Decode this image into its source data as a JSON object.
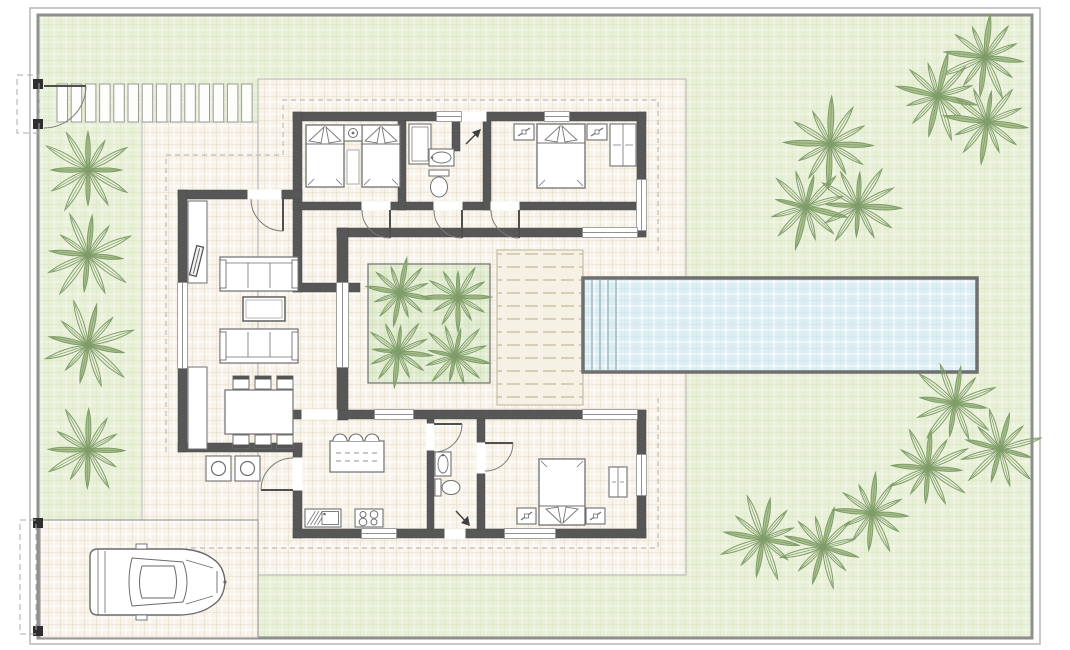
{
  "canvas": {
    "width": 1070,
    "height": 650,
    "background": "#ffffff"
  },
  "colors": {
    "wall": "#575757",
    "wall_light": "#6e6e6e",
    "line": "#6a6a6a",
    "furn": "#707070",
    "garden_bg": "#e8efd7",
    "garden_line": "#f6f9ee",
    "terrace_bg": "#f7f3ea",
    "terrace_line": "#ffffff",
    "terrace_accent": "#e4dac7",
    "planter_bg": "#dfead0",
    "planter_line": "#f0f6e3",
    "pool_bg": "#ddeef3",
    "pool_line": "#ffffff",
    "pool_border": "#6f6f6f",
    "palm": "#7f9c69",
    "palm_fill": "#a9c08d",
    "border_outer": "#b7b7b7",
    "border_inner": "#8f8f8f",
    "dash": "#bdbdbd",
    "deck_dash": "#c6b999",
    "white": "#ffffff"
  },
  "plot": {
    "outer": [
      30,
      8,
      1010,
      636
    ],
    "inner": [
      38,
      15,
      994,
      623
    ]
  },
  "regions": [
    {
      "name": "terrace-west",
      "rect": [
        142,
        122,
        116,
        453
      ],
      "pat": "patTerrace",
      "stroke": "#c6c6c6"
    },
    {
      "name": "terrace-main",
      "rect": [
        258,
        79,
        428,
        496
      ],
      "pat": "patTerrace",
      "stroke": "#bdbdbd"
    },
    {
      "name": "driveway",
      "rect": [
        40,
        520,
        218,
        118
      ],
      "pat": "patTerrace",
      "stroke": "#9e9e9e"
    },
    {
      "name": "deck",
      "rect": [
        497,
        250,
        86,
        155
      ],
      "pat": "patDeck",
      "stroke": "#c9bda6"
    },
    {
      "name": "courtyard-planter",
      "rect": [
        368,
        264,
        122,
        119
      ],
      "pat": "patPlanter",
      "stroke": "#6f6f6f"
    }
  ],
  "slabs": {
    "x0": 57,
    "y": 84,
    "w": 10.5,
    "h": 38,
    "pitch": 14.2,
    "count": 14
  },
  "pool": {
    "rect": [
      583,
      278,
      394,
      94
    ],
    "steps_x": [
      592,
      600,
      608,
      616
    ]
  },
  "overhang_dashes": [
    [
      [
        166,
        452
      ],
      [
        166,
        155
      ],
      [
        283,
        155
      ],
      [
        283,
        100
      ],
      [
        658,
        100
      ],
      [
        658,
        252
      ]
    ],
    [
      [
        658,
        398
      ],
      [
        658,
        548
      ],
      [
        186,
        548
      ]
    ]
  ],
  "walls": [
    [
      293,
      112,
      353,
      9
    ],
    [
      293,
      112,
      9,
      180
    ],
    [
      637,
      112,
      9,
      125
    ],
    [
      293,
      202,
      353,
      8
    ],
    [
      398,
      121,
      8,
      89
    ],
    [
      483,
      121,
      8,
      89
    ],
    [
      452,
      121,
      8,
      30
    ],
    [
      337,
      228,
      309,
      9
    ],
    [
      337,
      228,
      11,
      192
    ],
    [
      293,
      283,
      67,
      9
    ],
    [
      178,
      190,
      124,
      9
    ],
    [
      178,
      190,
      9,
      262
    ],
    [
      178,
      443,
      124,
      9
    ],
    [
      293,
      410,
      353,
      9
    ],
    [
      293,
      443,
      9,
      95
    ],
    [
      637,
      410,
      9,
      128
    ],
    [
      293,
      529,
      353,
      9
    ],
    [
      427,
      419,
      7,
      110
    ],
    [
      477,
      419,
      8,
      110
    ]
  ],
  "windows": [
    [
      437,
      112,
      24,
      9,
      "h"
    ],
    [
      545,
      112,
      24,
      9,
      "h"
    ],
    [
      637,
      180,
      9,
      50,
      "v"
    ],
    [
      583,
      228,
      54,
      9,
      "h"
    ],
    [
      337,
      283,
      11,
      84,
      "v"
    ],
    [
      178,
      283,
      9,
      85,
      "v"
    ],
    [
      375,
      410,
      38,
      9,
      "h"
    ],
    [
      583,
      410,
      54,
      9,
      "h"
    ],
    [
      637,
      455,
      9,
      40,
      "v"
    ],
    [
      362,
      529,
      34,
      9,
      "h"
    ],
    [
      505,
      529,
      50,
      9,
      "h"
    ]
  ],
  "gaps": [
    [
      462,
      112,
      24,
      9
    ],
    [
      248,
      190,
      33,
      9
    ],
    [
      362,
      202,
      28,
      8
    ],
    [
      434,
      202,
      28,
      8
    ],
    [
      491,
      202,
      28,
      8
    ],
    [
      302,
      410,
      35,
      9
    ],
    [
      293,
      458,
      9,
      32
    ],
    [
      427,
      424,
      7,
      26
    ],
    [
      477,
      443,
      8,
      30
    ],
    [
      445,
      529,
      20,
      9
    ]
  ],
  "doors": [
    {
      "name": "pedestrian-gate-door",
      "leaf": "M44,86 L86,86",
      "arc": "M86,86 A42,42 0 0 1 44,128"
    },
    {
      "name": "living-terrace-door",
      "leaf": "M283,199 L283,231",
      "arc": "M283,231 A32,32 0 0 1 251,199"
    },
    {
      "name": "bedroom1-door",
      "leaf": "M390,210 L390,238",
      "arc": "M390,238 A28,28 0 0 1 362,210"
    },
    {
      "name": "bathroom1-door",
      "leaf": "M462,210 L462,238",
      "arc": "M462,238 A28,28 0 0 1 434,210"
    },
    {
      "name": "bedroom2-door",
      "leaf": "M519,210 L519,238",
      "arc": "M519,238 A28,28 0 0 1 491,210"
    },
    {
      "name": "kitchen-porch-door",
      "leaf": "M293,490 L261,490",
      "arc": "M261,490 A32,32 0 0 1 293,458"
    },
    {
      "name": "bathroom2-door",
      "leaf": "M434,424 L462,424",
      "arc": "M462,424 A28,28 0 0 1 434,452"
    },
    {
      "name": "bedroom3-door",
      "leaf": "M485,443 L513,443",
      "arc": "M513,443 A28,28 0 0 1 485,471"
    }
  ],
  "furniture": [
    {
      "t": "bed",
      "x": 306,
      "y": 125,
      "w": 38,
      "h": 62,
      "p": "top",
      "name": "twin-bed-1"
    },
    {
      "t": "bed",
      "x": 362,
      "y": 125,
      "w": 38,
      "h": 62,
      "p": "top",
      "name": "twin-bed-2"
    },
    {
      "t": "nightstand",
      "x": 344,
      "y": 125,
      "w": 18,
      "h": 16,
      "lamp": "circle",
      "name": "nightstand"
    },
    {
      "t": "rug",
      "x": 347,
      "y": 150,
      "w": 12,
      "h": 34,
      "name": "bedroom-rug"
    },
    {
      "t": "shower",
      "x": 409,
      "y": 124,
      "w": 22,
      "h": 40,
      "name": "shower"
    },
    {
      "t": "sink",
      "x": 429,
      "y": 149,
      "w": 25,
      "h": 17,
      "o": "h",
      "name": "bathroom1-sink"
    },
    {
      "t": "toilet",
      "x": 429,
      "y": 170,
      "w": 20,
      "h": 28,
      "o": "v",
      "name": "bathroom1-toilet"
    },
    {
      "t": "bed",
      "x": 537,
      "y": 124,
      "w": 48,
      "h": 64,
      "p": "top",
      "name": "double-bed-1"
    },
    {
      "t": "nightstand",
      "x": 514,
      "y": 124,
      "w": 20,
      "h": 16,
      "lamp": "diag",
      "name": "nightstand"
    },
    {
      "t": "nightstand",
      "x": 587,
      "y": 124,
      "w": 20,
      "h": 16,
      "lamp": "diag",
      "name": "nightstand"
    },
    {
      "t": "wardrobe",
      "x": 610,
      "y": 124,
      "w": 26,
      "h": 42,
      "name": "wardrobe"
    },
    {
      "t": "console",
      "x": 188,
      "y": 201,
      "w": 19,
      "h": 82,
      "name": "tv-console"
    },
    {
      "t": "tv",
      "x": 193,
      "y": 246,
      "w": 7,
      "h": 30,
      "name": "tv"
    },
    {
      "t": "console",
      "x": 188,
      "y": 367,
      "w": 19,
      "h": 82,
      "name": "sideboard"
    },
    {
      "t": "sofa",
      "x": 220,
      "y": 257,
      "w": 78,
      "h": 34,
      "back": "top",
      "name": "sofa-1"
    },
    {
      "t": "ctable",
      "x": 243,
      "y": 297,
      "w": 42,
      "h": 24,
      "name": "coffee-table"
    },
    {
      "t": "sofa",
      "x": 220,
      "y": 329,
      "w": 78,
      "h": 34,
      "back": "bottom",
      "name": "sofa-2"
    },
    {
      "t": "dining",
      "x": 225,
      "y": 390,
      "w": 68,
      "h": 44,
      "name": "dining-table"
    },
    {
      "t": "stool",
      "x": 206,
      "y": 456,
      "w": 25,
      "h": 25,
      "name": "porch-stool"
    },
    {
      "t": "stool",
      "x": 235,
      "y": 456,
      "w": 25,
      "h": 25,
      "name": "porch-stool"
    },
    {
      "t": "island",
      "x": 330,
      "y": 441,
      "w": 54,
      "h": 31,
      "name": "kitchen-island"
    },
    {
      "t": "sinkunit",
      "x": 305,
      "y": 509,
      "w": 36,
      "h": 18,
      "name": "kitchen-sink-unit"
    },
    {
      "t": "stove",
      "x": 355,
      "y": 509,
      "w": 28,
      "h": 18,
      "name": "stove"
    },
    {
      "t": "sink",
      "x": 435,
      "y": 452,
      "w": 16,
      "h": 24,
      "o": "v",
      "name": "bathroom2-sink"
    },
    {
      "t": "toilet",
      "x": 435,
      "y": 479,
      "w": 26,
      "h": 17,
      "o": "h",
      "name": "bathroom2-toilet"
    },
    {
      "t": "bed",
      "x": 539,
      "y": 459,
      "w": 46,
      "h": 66,
      "p": "bottom",
      "name": "double-bed-2"
    },
    {
      "t": "nightstand",
      "x": 517,
      "y": 508,
      "w": 19,
      "h": 16,
      "lamp": "diag",
      "name": "nightstand"
    },
    {
      "t": "nightstand",
      "x": 586,
      "y": 508,
      "w": 19,
      "h": 16,
      "lamp": "diag",
      "name": "nightstand"
    },
    {
      "t": "wardrobe",
      "x": 609,
      "y": 467,
      "w": 18,
      "h": 30,
      "name": "wardrobe"
    }
  ],
  "trees": [
    [
      88,
      170,
      48
    ],
    [
      88,
      255,
      48
    ],
    [
      88,
      345,
      48
    ],
    [
      88,
      450,
      46
    ],
    [
      985,
      57,
      46
    ],
    [
      938,
      96,
      46
    ],
    [
      830,
      144,
      48
    ],
    [
      987,
      122,
      44
    ],
    [
      806,
      207,
      44
    ],
    [
      858,
      206,
      44
    ],
    [
      955,
      403,
      46
    ],
    [
      1000,
      449,
      44
    ],
    [
      928,
      468,
      44
    ],
    [
      763,
      539,
      46
    ],
    [
      823,
      547,
      44
    ],
    [
      872,
      513,
      42
    ],
    [
      400,
      293,
      36
    ],
    [
      458,
      297,
      36
    ],
    [
      398,
      352,
      36
    ],
    [
      455,
      356,
      36
    ]
  ],
  "car": {
    "x": 86,
    "y": 546
  },
  "gates": {
    "posts": [
      [
        33,
        79,
        10,
        10
      ],
      [
        33,
        119,
        10,
        10
      ],
      [
        33,
        518,
        10,
        10
      ],
      [
        33,
        626,
        10,
        10
      ]
    ],
    "dashed": [
      [
        17,
        75,
        22,
        58
      ],
      [
        20,
        520,
        16,
        114
      ]
    ]
  },
  "arrows": [
    {
      "name": "entry-arrow-top",
      "line": [
        466,
        144,
        480,
        130
      ],
      "head": [
        [
          481,
          129
        ],
        [
          472,
          132
        ],
        [
          478,
          138
        ]
      ]
    },
    {
      "name": "entry-arrow-bottom",
      "line": [
        456,
        511,
        469,
        525
      ],
      "head": [
        [
          470,
          526
        ],
        [
          461,
          523
        ],
        [
          468,
          516
        ]
      ]
    }
  ]
}
